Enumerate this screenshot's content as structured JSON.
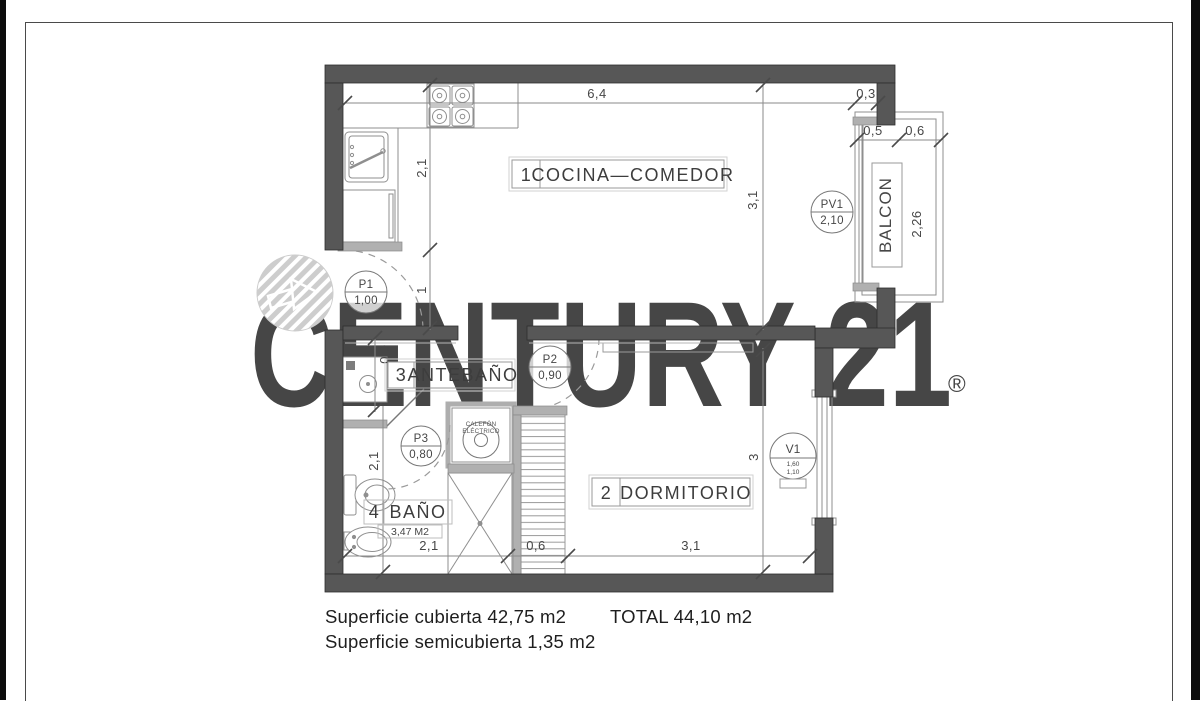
{
  "watermark": {
    "brand": "CENTURY 21",
    "reg": "®"
  },
  "rooms": {
    "r1_num": "1",
    "r1_name": "COCINA—COMEDOR",
    "r2_num": "2",
    "r2_name": "DORMITORIO",
    "r3_num": "3",
    "r3_name": "ANTEBAÑO",
    "r4_num": "4",
    "r4_name": "BAÑO",
    "r4_area": "3,47 M2",
    "balcony": "BALCON"
  },
  "doors": {
    "p1_id": "P1",
    "p1_size": "1,00",
    "p2_id": "P2",
    "p2_size": "0,90",
    "p3_id": "P3",
    "p3_size": "0,80",
    "pv1_id": "PV1",
    "pv1_size": "2,10",
    "v1_id": "V1",
    "v1_size_a": "1,60",
    "v1_size_b": "1,10"
  },
  "equipment": {
    "calefon_l1": "CALEFÓN",
    "calefon_l2": "ELÉCTRICO"
  },
  "dims": {
    "top_main": "6,4",
    "top_right": "0,3",
    "balc_w1": "0,5",
    "balc_w2": "0,6",
    "balc_len": "2,26",
    "kitchen_h": "2,1",
    "p1_opening": "1",
    "kitchen_right_h": "3,1",
    "hall_w": "0,9",
    "bath_h": "2,1",
    "dorm_h": "3",
    "bottom_left": "2,1",
    "bottom_mid": "0,6",
    "bottom_right": "3,1"
  },
  "footer": {
    "covered": "Superficie cubierta 42,75 m2",
    "semi": "Superficie semicubierta 1,35 m2",
    "total": "TOTAL 44,10 m2"
  },
  "colors": {
    "wall": "#575757",
    "light_wall": "#b0b0b0",
    "watermark": "#c6c6c6",
    "line": "#8a8a8a",
    "text": "#3d3d3d"
  }
}
